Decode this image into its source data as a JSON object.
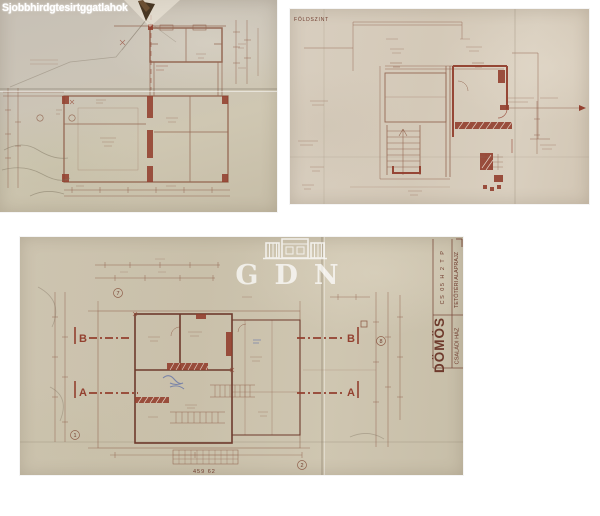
{
  "page": {
    "background": "#ffffff"
  },
  "watermarks": {
    "corner_text": "Sjobbhirdgtesirtggatlahok",
    "brand": "GDN"
  },
  "photos": {
    "ground_floor": {
      "label": "FÖLDSZINT"
    },
    "attic": {
      "section_b": "B",
      "section_a": "A",
      "grid_bubbles": [
        "7",
        "8",
        "1",
        "2"
      ],
      "dimension_note": "459 62",
      "title_block": {
        "location": "DÖMÖS",
        "building": "CSALÁDI HÁZ",
        "code": "CS 05 H 2 T P",
        "sheet": "TETŐTÉRI ALAPRAJZ"
      }
    }
  },
  "colors": {
    "paper_a": "#c9c1b3",
    "paper_b": "#d6ccbd",
    "paper_c": "#ccc3ae",
    "ink": "#8f5f4a",
    "ink_dark": "#6e3a2c",
    "wall_red": "#93402f",
    "pencil_blue": "#5e6fa8"
  }
}
